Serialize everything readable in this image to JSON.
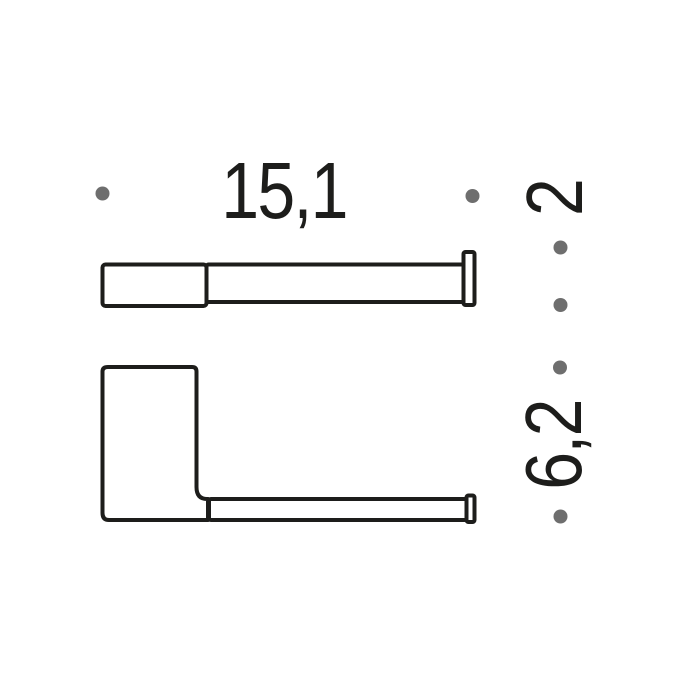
{
  "drawing": {
    "type": "technical-dimension-drawing",
    "subject": "wall-mounted holder, top view and side view",
    "dimensions": {
      "width_label": "15,1",
      "depth_label": "2",
      "height_label": "6,2"
    },
    "colors": {
      "line": "#1d1d1b",
      "text": "#1d1d1b",
      "dot": "#6e6e6e",
      "background": "#ffffff"
    }
  }
}
